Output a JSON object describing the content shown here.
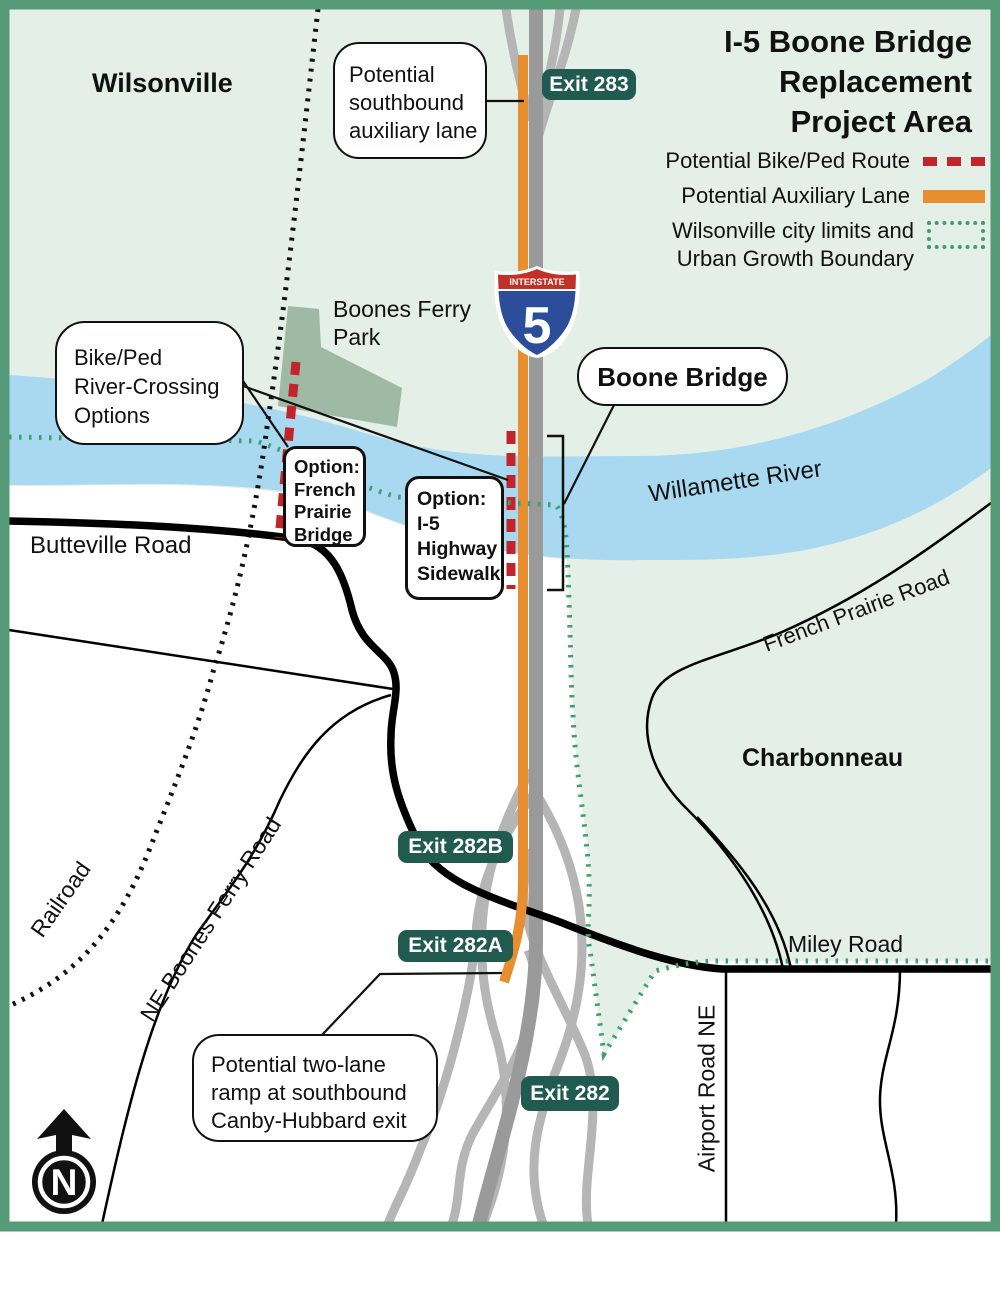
{
  "title": {
    "lines": [
      "I-5 Boone Bridge",
      "Replacement",
      "Project Area"
    ]
  },
  "legend": {
    "items": [
      {
        "label": "Potential Bike/Ped Route",
        "swatch": "red-dashed-line",
        "color": "#c2242b"
      },
      {
        "label": "Potential Auxiliary Lane",
        "swatch": "orange-solid-line",
        "color": "#e78f30"
      },
      {
        "label_lines": [
          "Wilsonville city limits and",
          "Urban Growth Boundary"
        ],
        "swatch": "green-dotted-box",
        "color": "#3ea06e"
      }
    ]
  },
  "places": {
    "wilsonville": "Wilsonville",
    "charbonneau": "Charbonneau",
    "boones_ferry_park": {
      "lines": [
        "Boones Ferry",
        "Park"
      ]
    },
    "willamette_river": "Willamette River"
  },
  "roads": {
    "butteville": "Butteville Road",
    "french_prairie": "French Prairie Road",
    "miley": "Miley Road",
    "ne_boones_ferry": "NE Boones Ferry Road",
    "airport": "Airport Road NE",
    "railroad": "Railroad"
  },
  "exits": {
    "exit283": "Exit 283",
    "exit282b": "Exit 282B",
    "exit282a": "Exit 282A",
    "exit282": "Exit 282"
  },
  "callouts": {
    "southbound_aux": {
      "lines": [
        "Potential",
        "southbound",
        "auxiliary lane"
      ]
    },
    "bike_ped": {
      "lines": [
        "Bike/Ped",
        "River-Crossing",
        "Options"
      ]
    },
    "option_french_prairie": {
      "lines": [
        "Option:",
        "French",
        "Prairie",
        "Bridge"
      ]
    },
    "option_sidewalk": {
      "lines": [
        "Option:",
        "I-5",
        "Highway",
        "Sidewalk"
      ]
    },
    "boone_bridge": {
      "label": "Boone Bridge"
    },
    "two_lane_ramp": {
      "lines": [
        "Potential two-lane",
        "ramp at southbound",
        "Canby-Hubbard exit"
      ]
    }
  },
  "shield": {
    "top": "INTERSTATE",
    "number": "5"
  },
  "north_arrow": {
    "label": "N"
  },
  "colors": {
    "frame_green": "#569b78",
    "city_fill_green": "#e4efe8",
    "river_blue": "#a9d9f1",
    "park_green": "#9fbaa4",
    "highway_gray": "#9a9a9a",
    "ramp_gray": "#b5b5b5",
    "auxiliary_orange": "#e78f30",
    "bike_ped_red": "#c2242b",
    "boundary_green": "#3ea06e",
    "exit_badge_teal": "#215a50"
  }
}
